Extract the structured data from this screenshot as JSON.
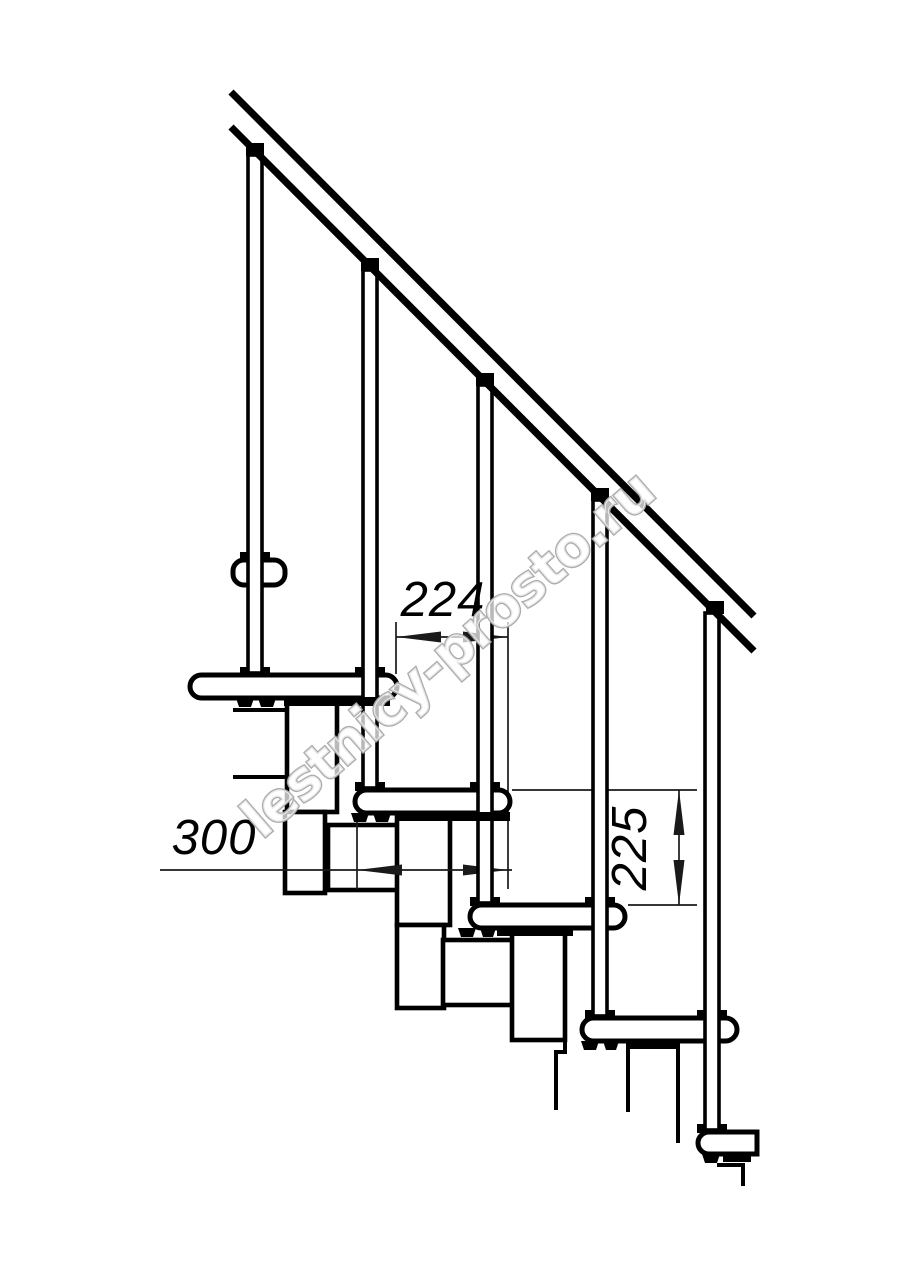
{
  "drawing": {
    "dimensions": {
      "tread_overlap": "224",
      "tread_depth": "300",
      "riser_height": "225"
    },
    "watermark": "lestnicy-prosto.ru"
  }
}
